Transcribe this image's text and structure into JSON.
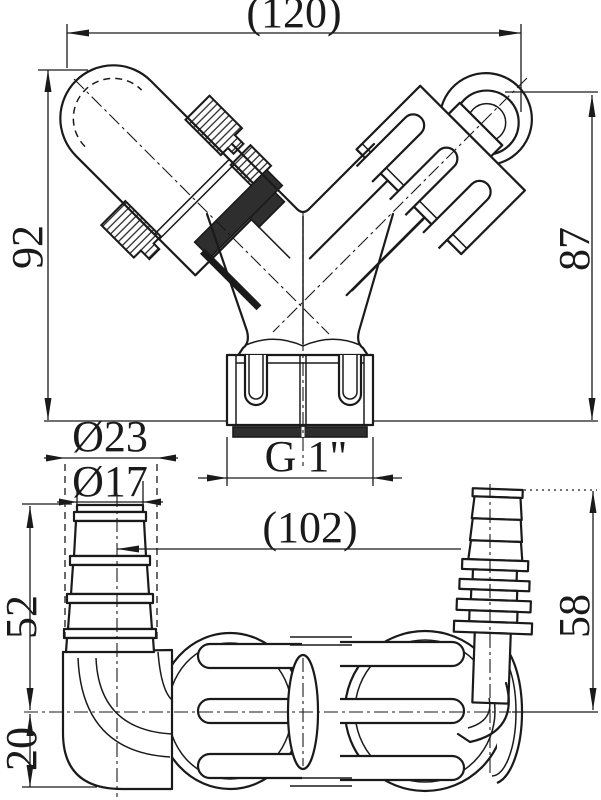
{
  "drawing": {
    "kind": "engineering line drawing, two orthographic views of a Y-shaped double hose connector fitting"
  },
  "dimensions": {
    "top_width": "(120)",
    "left_height": "92",
    "right_height": "87",
    "thread_size": "G 1\"",
    "outer_diameter": "Ø23",
    "inner_diameter": "Ø17",
    "left_hose_height": "52",
    "elbow_offset": "20",
    "bottom_width": "(102)",
    "right_hose_height": "58"
  },
  "colors": {
    "background": "#ffffff",
    "line_color": "#1a1a1a",
    "seal_fill": "#2e2e2e"
  }
}
